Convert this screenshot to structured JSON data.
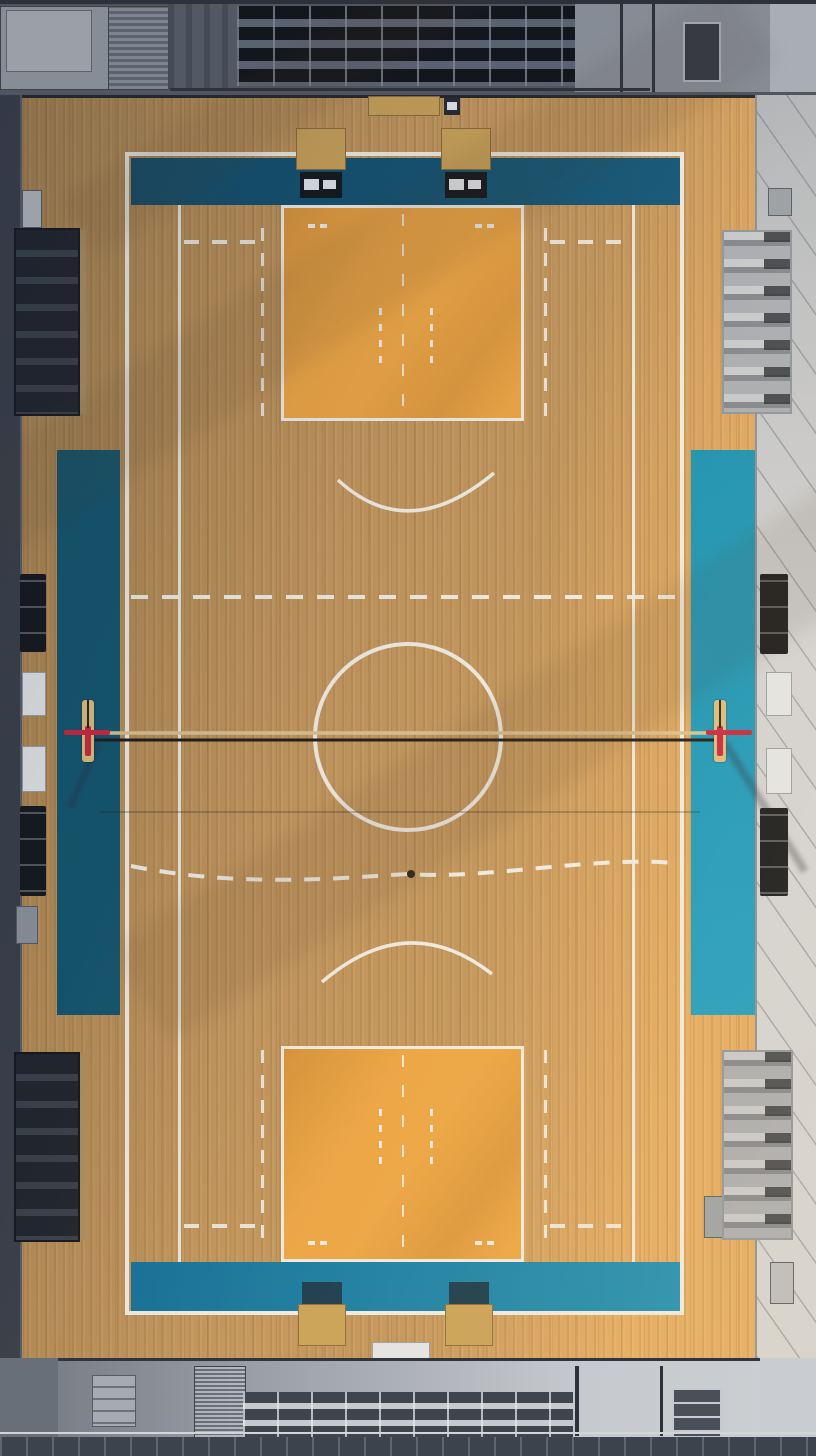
{
  "scene": {
    "type": "aerial-photograph",
    "description": "Top-down aerial view of an indoor gymnasium: wooden multi-sport court with white markings, volleyball net strung between two red padded posts, deep-teal painted end zones and side panels, orange basketball key rectangles, gray bleachers at top and bottom, folding seat blocks and equipment along the side margins",
    "elements": [
      "top-bleachers",
      "bottom-bleachers",
      "hall-floor",
      "court-boundary",
      "end-zone-top",
      "end-zone-bottom",
      "side-panel-left",
      "side-panel-right",
      "key-top",
      "key-bottom",
      "center-circle",
      "halfway-dashed-line",
      "curved-dashed-line",
      "free-throw-arc-top",
      "free-throw-arc-bottom",
      "volleyball-net",
      "net-post-left",
      "net-post-right",
      "team-bench-top-left",
      "team-bench-top-right",
      "team-bench-bottom-left",
      "team-bench-bottom-right",
      "scoreboard-boxes",
      "equipment-boxes",
      "folding-seat-blocks",
      "left-wall",
      "right-wall",
      "stairs",
      "walkway"
    ]
  },
  "palette": {
    "wood_mid": "#c2955c",
    "wood_dark": "#a8834e",
    "wood_light": "#e4ac63",
    "line_white": "#efece4",
    "teal_top_a": "#144e6a",
    "teal_top_b": "#13587a",
    "teal_bottom_a": "#14719a",
    "teal_bottom_b": "#1c8fb4",
    "teal_side_left": "#14566f",
    "teal_side_right_a": "#1b93b4",
    "teal_side_right_b": "#1d9ec2",
    "key_orange": "#eca544",
    "net_band": "#d8c294",
    "net_dark": "#1f1d18",
    "post_red": "#c9283e",
    "post_pad": "#dcbd7e",
    "stand_top_base": "#4f5662",
    "seat_dark": "#12161d",
    "seat_gap": "#5a6170",
    "stand_bottom_dark": "#70767f",
    "stand_bottom_light": "#cdd0d3",
    "wall_left": "#3a404a",
    "wall_right_a": "#b3b7bd",
    "wall_right_b": "#d3d5d8",
    "equip_black": "#15181d",
    "equip_white": "#e4e6e8",
    "bench_tan": "#c9a158",
    "bench_seat_teal": "#173a4d",
    "cabinet_gray": "#a6abb2",
    "walkway_dark": "#3d434c"
  }
}
